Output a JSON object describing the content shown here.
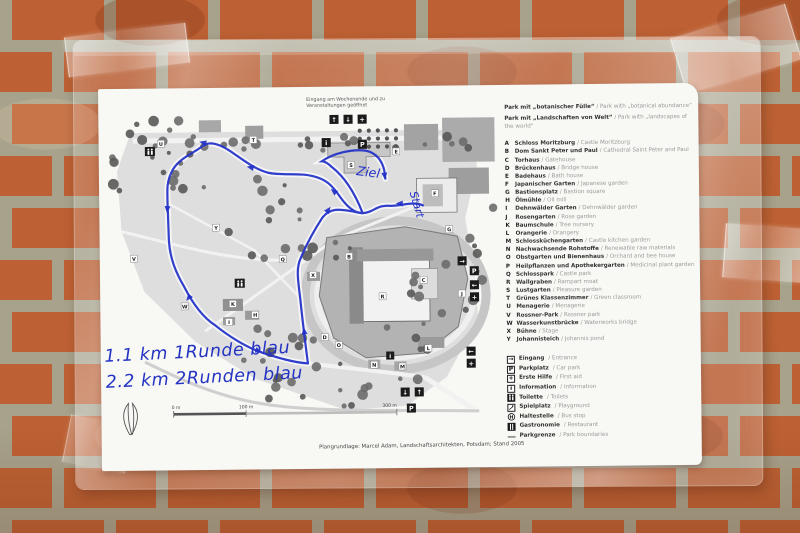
{
  "map": {
    "entrance_note_line1": "Eingang am Wochenende und zu",
    "entrance_note_line2": "Veranstaltungen geöffnet",
    "parking_label": "P",
    "info_label": "i",
    "icon_glyphs": {
      "up": "↑",
      "down": "↓",
      "left": "←",
      "right": "→",
      "plus": "+"
    },
    "markers": [
      "U",
      "T",
      "S",
      "E",
      "F",
      "G",
      "H",
      "Y",
      "Q",
      "B",
      "R",
      "C",
      "X",
      "W",
      "K",
      "I",
      "D",
      "O",
      "N",
      "M",
      "L",
      "J",
      "V"
    ]
  },
  "annotations": {
    "line1": "1.1 km  1Runde blau",
    "line2": "2.2 km  2Runden blau",
    "ziel": "Ziel",
    "start": "Start"
  },
  "scalebar": {
    "zero": "0 m",
    "mid": "100 m",
    "end": "300 m"
  },
  "caption": "Plangrundlage: Marcel Adam, Landschaftsarchitekten, Potsdam; Stand 2005",
  "legend": {
    "titles": [
      {
        "de": "Park mit „botanischer Fülle“",
        "en": "/ Park with „botanical abundance“"
      },
      {
        "de": "Park mit „Landschaften von Welt“",
        "en": "/ Park with „landscapes of the world“"
      }
    ],
    "items": [
      {
        "key": "A",
        "de": "Schloss Moritzburg",
        "en": "/ Castle Moritzburg"
      },
      {
        "key": "B",
        "de": "Dom Sankt Peter und Paul",
        "en": "/ Cathedral Saint Peter and Paul"
      },
      {
        "key": "C",
        "de": "Torhaus",
        "en": "/ Gatehouse"
      },
      {
        "key": "D",
        "de": "Brückenhaus",
        "en": "/ Bridge house"
      },
      {
        "key": "E",
        "de": "Badehaus",
        "en": "/ Bath house"
      },
      {
        "key": "F",
        "de": "Japanischer Garten",
        "en": "/ Japanese garden"
      },
      {
        "key": "G",
        "de": "Bastionsplatz",
        "en": "/ Bastion square"
      },
      {
        "key": "H",
        "de": "Ölmühle",
        "en": "/ Oil mill"
      },
      {
        "key": "I",
        "de": "Dehnwälder Garten",
        "en": "/ Dehnwälder garden"
      },
      {
        "key": "J",
        "de": "Rosengarten",
        "en": "/ Rose garden"
      },
      {
        "key": "K",
        "de": "Baumschule",
        "en": "/ Tree nursery"
      },
      {
        "key": "L",
        "de": "Orangerie",
        "en": "/ Orangery"
      },
      {
        "key": "M",
        "de": "Schlossküchengarten",
        "en": "/ Castle kitchen garden"
      },
      {
        "key": "N",
        "de": "Nachwachsende Rohstoffe",
        "en": "/ Renewable raw materials"
      },
      {
        "key": "O",
        "de": "Obstgarten und Bienenhaus",
        "en": "/ Orchard and bee house"
      },
      {
        "key": "P",
        "de": "Heilpflanzen und Apothekergarten",
        "en": "/ Medicinal plant garden"
      },
      {
        "key": "Q",
        "de": "Schlosspark",
        "en": "/ Castle park"
      },
      {
        "key": "R",
        "de": "Wallgraben",
        "en": "/ Rampart moat"
      },
      {
        "key": "S",
        "de": "Lustgarten",
        "en": "/ Pleasure garden"
      },
      {
        "key": "T",
        "de": "Grünes Klassenzimmer",
        "en": "/ Green classroom"
      },
      {
        "key": "U",
        "de": "Menagerie",
        "en": "/ Menagerie"
      },
      {
        "key": "V",
        "de": "Rossner-Park",
        "en": "/ Rossner park"
      },
      {
        "key": "W",
        "de": "Wasserkunstbrücke",
        "en": "/ Waterworks bridge"
      },
      {
        "key": "X",
        "de": "Bühne",
        "en": "/ Stage"
      },
      {
        "key": "Y",
        "de": "Johannisteich",
        "en": "/ Johannis pond"
      }
    ],
    "icons": [
      {
        "name": "entrance-arrow-icon",
        "glyph": "→",
        "de": "Eingang",
        "en": "/ Entrance"
      },
      {
        "name": "parking-icon",
        "glyph": "P",
        "de": "Parkplatz",
        "en": "/ Car park"
      },
      {
        "name": "first-aid-icon",
        "glyph": "+",
        "de": "Erste Hilfe",
        "en": "/ First aid"
      },
      {
        "name": "information-icon",
        "glyph": "i",
        "de": "Information",
        "en": "/ Information"
      },
      {
        "name": "toilet-icon",
        "glyph": "",
        "de": "Toilette",
        "en": "/ Toilets"
      },
      {
        "name": "playground-icon",
        "glyph": "",
        "de": "Spielplatz",
        "en": "/ Playground"
      },
      {
        "name": "bus-stop-icon",
        "glyph": "H",
        "de": "Haltestelle",
        "en": "/ Bus stop"
      },
      {
        "name": "restaurant-icon",
        "glyph": "",
        "de": "Gastronomie",
        "en": "/ Restaurant"
      },
      {
        "name": "boundary-line-icon",
        "glyph": "",
        "de": "Parkgrenze",
        "en": "/ Park boundaries"
      }
    ]
  }
}
